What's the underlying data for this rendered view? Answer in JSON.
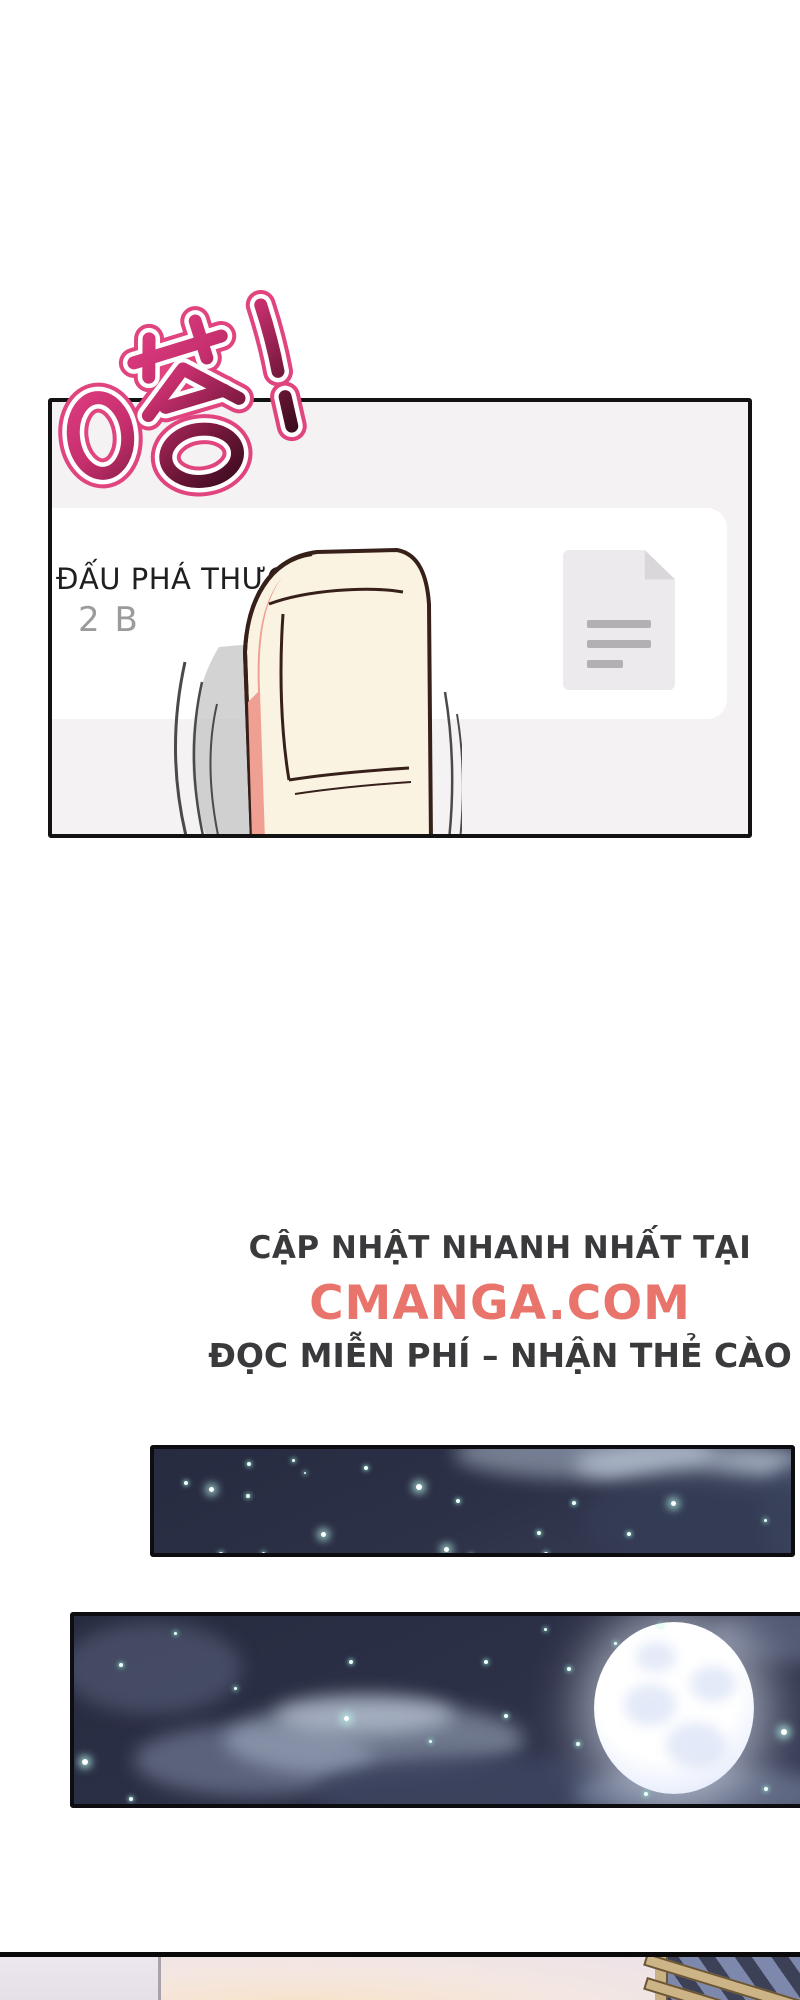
{
  "page": {
    "background": "#ffffff"
  },
  "sfx": {
    "text": "嗒!",
    "meaning": "tap sound effect",
    "fill_top": "#e84289",
    "fill_bottom": "#15040c",
    "outline_inner": "#ffffff",
    "outline_outer": "#e0457f"
  },
  "app_panel": {
    "title": "ĐẤU PHÁ THƯƠN",
    "subtitle": "2 B",
    "background": "#f4f2f3",
    "card_background": "#ffffff",
    "icon": "document-icon"
  },
  "promo": {
    "line1": "CẬP NHẬT NHANH NHẤT TẠI",
    "site": "CMANGA.COM",
    "line3": "ĐỌC MIỄN PHÍ – NHẬN THẺ CÀO",
    "accent_color": "#e8746c",
    "text_color": "#3a3a3c"
  },
  "night_panel_1": {
    "sky_color": "#2b2f46",
    "stars": [
      [
        30,
        32,
        4
      ],
      [
        55,
        38,
        5
      ],
      [
        93,
        13,
        4
      ],
      [
        92,
        45,
        4
      ],
      [
        138,
        10,
        3
      ],
      [
        150,
        23,
        2
      ],
      [
        210,
        17,
        4
      ],
      [
        262,
        35,
        6
      ],
      [
        167,
        83,
        5
      ],
      [
        65,
        103,
        4
      ],
      [
        108,
        103,
        3
      ],
      [
        290,
        98,
        5
      ],
      [
        315,
        105,
        4
      ],
      [
        302,
        50,
        4
      ],
      [
        383,
        82,
        4
      ],
      [
        418,
        52,
        4
      ],
      [
        517,
        52,
        5
      ],
      [
        473,
        83,
        4
      ],
      [
        390,
        103,
        4
      ],
      [
        610,
        70,
        3
      ]
    ]
  },
  "night_panel_2": {
    "sky_color": "#2b2f46",
    "moon": {
      "x": 520,
      "y": 6,
      "diameter": 166,
      "color": "#ffffff"
    },
    "stars": [
      [
        45,
        47,
        4
      ],
      [
        100,
        16,
        3
      ],
      [
        160,
        71,
        3
      ],
      [
        275,
        44,
        4
      ],
      [
        270,
        100,
        5
      ],
      [
        8,
        143,
        6
      ],
      [
        55,
        181,
        4
      ],
      [
        410,
        44,
        4
      ],
      [
        430,
        98,
        4
      ],
      [
        355,
        124,
        3
      ],
      [
        493,
        51,
        4
      ],
      [
        502,
        126,
        4
      ],
      [
        707,
        113,
        6
      ],
      [
        690,
        171,
        4
      ],
      [
        570,
        176,
        4
      ],
      [
        540,
        26,
        3
      ],
      [
        585,
        8,
        3
      ],
      [
        470,
        12,
        3
      ]
    ]
  },
  "bottom_panel": {
    "wall_left_color": "#e9e4eb",
    "wall_mid_color": "#f4e7e2",
    "glow_color": "#f9e2c5",
    "window_dark": "#3d4157",
    "window_stripe": "#8d9ac2",
    "frame_color": "#c9b183"
  }
}
